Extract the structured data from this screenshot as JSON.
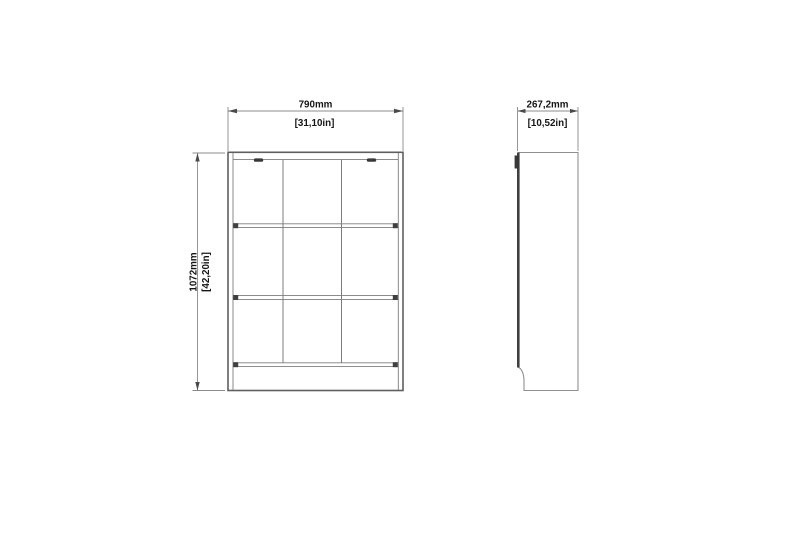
{
  "document": {
    "kind": "furniture-dimension-drawing",
    "background": "#ffffff"
  },
  "colors": {
    "background": "#ffffff",
    "object_line": "#5f5f5f",
    "object_line_light": "#7d7d7d",
    "object_line_strong": "#3f3f3f",
    "dimension_line": "#8b8b8b",
    "text": "#161616"
  },
  "views": {
    "front": {
      "label": "front-elevation-of-3x3-cube-bookcase",
      "grid_columns": 3,
      "grid_rows": 3,
      "width_dimension": {
        "mm": "790mm",
        "inches": "[31,10in]"
      },
      "height_dimension": {
        "mm": "1072mm",
        "inches": "[42,20in]"
      }
    },
    "side": {
      "label": "side-profile-with-plinth-notch",
      "depth_dimension": {
        "mm": "267,2mm",
        "inches": "[10,52in]"
      }
    }
  }
}
